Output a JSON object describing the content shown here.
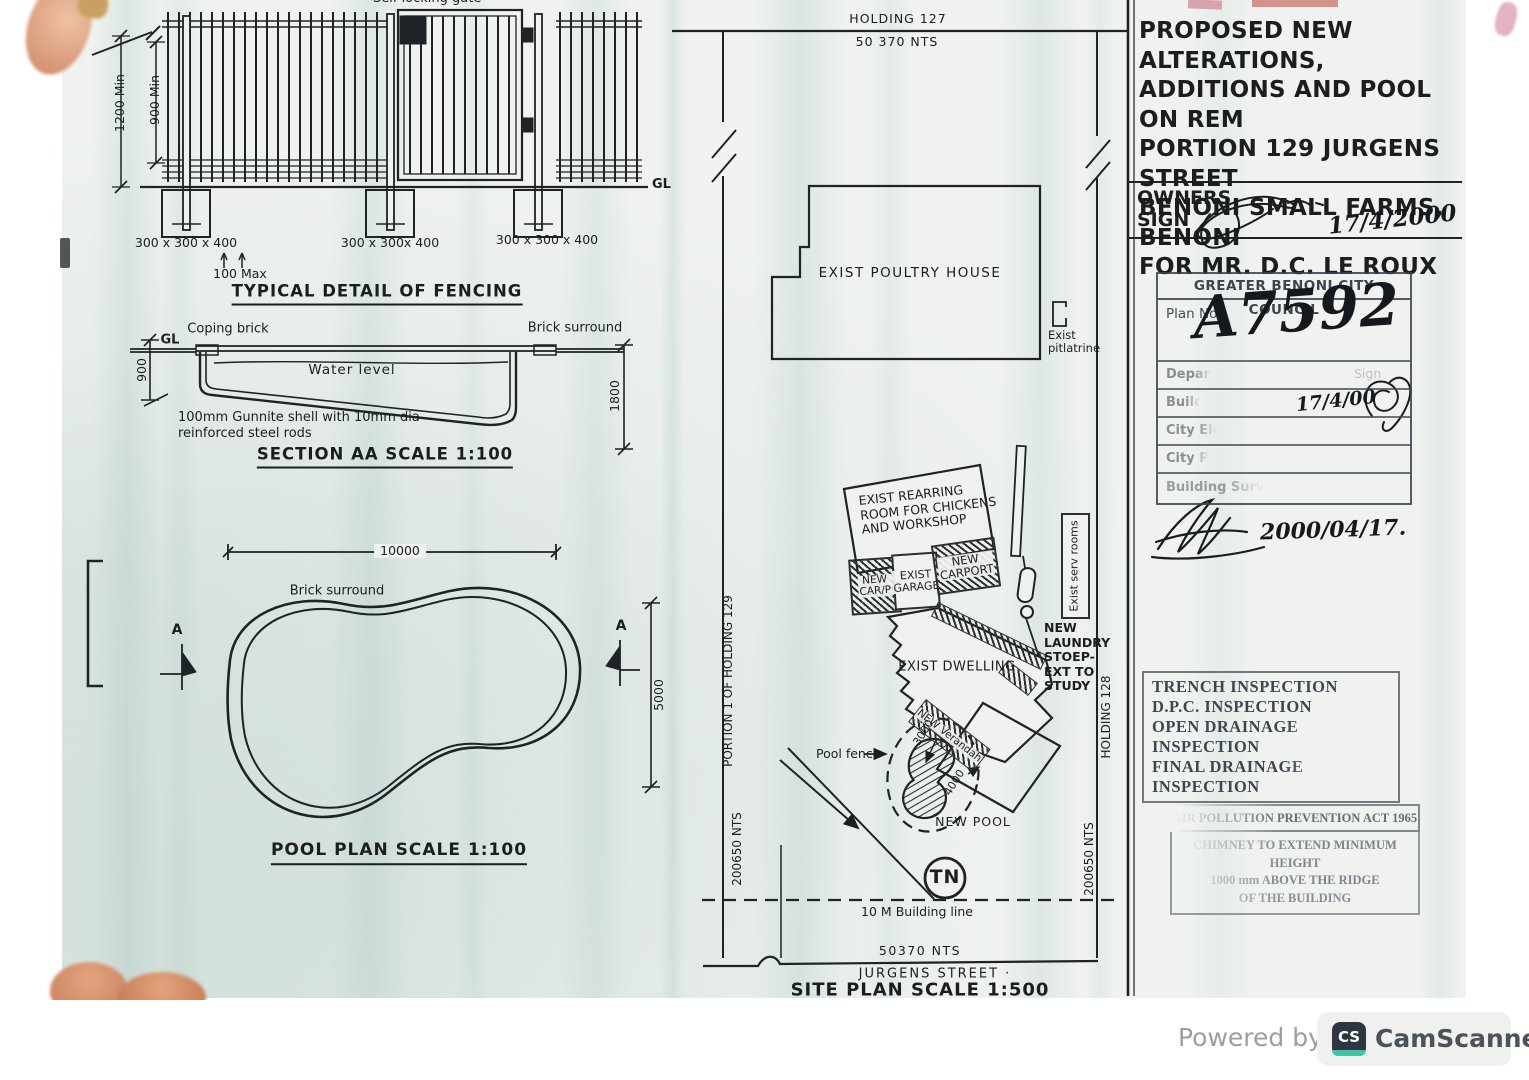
{
  "fencing": {
    "gate_label": "Self locking gate",
    "dim_1200": "1200 Min",
    "dim_900": "900 Min",
    "footing_labels": [
      "300 x 300 x 400",
      "300 x 300x 400",
      "300 x 300 x 400"
    ],
    "spacing_label": "100 Max",
    "gl_label": "GL",
    "title": "TYPICAL DETAIL OF FENCING"
  },
  "section_aa": {
    "gl_label": "GL",
    "coping_label": "Coping brick",
    "surround_label": "Brick surround",
    "water_label": "Water level",
    "dim_left": "900",
    "dim_right": "1800",
    "note": "100mm Gunnite shell with 10mm dia\nreinforced steel rods",
    "title": "SECTION AA SCALE 1:100"
  },
  "pool_plan": {
    "dim_width": "10000",
    "surround_label": "Brick surround",
    "marker_left": "A",
    "marker_right": "A",
    "dim_height": "5000",
    "title": "POOL PLAN SCALE 1:100"
  },
  "site_plan": {
    "north_boundary": "HOLDING 127",
    "north_dim": "50 370 NTS",
    "west_boundary": "PORTION 1 OF HOLDING 129",
    "west_dim": "200650 NTS",
    "east_boundary": "HOLDING 128",
    "east_dim": "200650 NTS",
    "poultry_label": "EXIST POULTRY HOUSE",
    "pitlatrine_label": "Exist\npitlatrine",
    "rearring_label": "EXIST REARRING\nROOM FOR CHICKENS\nAND WORKSHOP",
    "carp_label": "NEW\nCAR/P",
    "garage_label": "EXIST\nGARAGE",
    "carport_label": "NEW\nCARPORT",
    "serv_rooms_label": "Exist serv rooms",
    "dwelling_label": "EXIST DWELLING",
    "laundry_label": "NEW\nLAUNDRY\nSTOEP-\nEXT TO\nSTUDY",
    "verandah_label": "NEW\nVerandah",
    "dim_3000": "3000",
    "dim_4000": "4000",
    "pool_fence_label": "Pool fence",
    "new_pool_label": "NEW POOL",
    "north_symbol": "TN",
    "building_line_label": "10 M Building line",
    "south_dim": "50370 NTS",
    "street_label": "JURGENS STREET ·",
    "title": "SITE PLAN SCALE 1:500"
  },
  "title_block": {
    "project_title": "PROPOSED NEW ALTERATIONS,\nADDITIONS AND POOL ON REM\nPORTION 129 JURGENS STREET\nBENONI SMALL FARMS, BENONI\nFOR MR. D.C. LE ROUX",
    "owners_label": "OWNERS\nSIGN",
    "owners_date": "17/4/2000",
    "council_stamp": {
      "header": "GREATER BENONI CITY COUNCIL",
      "plan_no_label": "Plan No.",
      "plan_no_value": "A7592",
      "sign_label": "Sign",
      "rows": [
        "Depart",
        "Build",
        "City Ele",
        "City Pl",
        "Building Surve"
      ],
      "build_date": "17/4/00",
      "approval_date": "2000/04/17."
    },
    "inspection_stamp": [
      "TRENCH INSPECTION",
      "D.P.C. INSPECTION",
      "OPEN DRAINAGE INSPECTION",
      "FINAL DRAINAGE INSPECTION"
    ],
    "pollution_stamp": {
      "header": "AIR POLLUTION PREVENTION ACT 1965 Sec. 16",
      "lines": [
        "CHIMNEY TO EXTEND MINIMUM HEIGHT",
        "1000 mm  ABOVE THE RIDGE",
        "OF THE BUILDING"
      ]
    }
  },
  "footer": {
    "powered_by": "Powered by",
    "icon_text": "CS",
    "brand": "CamScanner"
  },
  "colors": {
    "paper": "#eff2ee",
    "ink": "#1c1e21",
    "stamp_ink": "#3e4651",
    "faded_stamp_ink": "#7e858d",
    "camscanner_teal": "#43c3a2",
    "footer_text": "#999fa2",
    "brand_text": "#4a525b"
  }
}
